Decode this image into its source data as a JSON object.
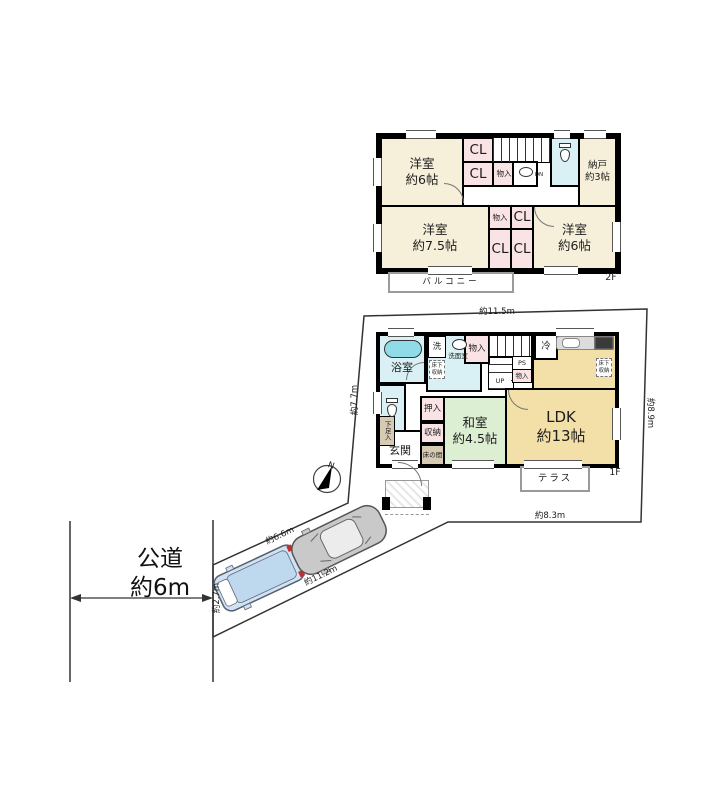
{
  "meta": {
    "title": "間取り図 (floor plan)"
  },
  "colors": {
    "room_cream": "#f6efda",
    "closet_pink": "#f9e3e5",
    "wet_blue": "#d9f1f4",
    "tatami_green": "#ddefd2",
    "ldk_tan": "#f3dfa8",
    "tokonoma_tan": "#d6cbb2",
    "tub_cyan": "#8fdbe8",
    "car_blue": "#cfe3f4",
    "car_gray": "#c9c9c9",
    "wall": "#000000"
  },
  "floor2": {
    "label": "2F",
    "room_nw": "洋室\n約6帖",
    "cl": "CL",
    "monoire": "物入",
    "dn": "DN",
    "nando": "納戸\n約3帖",
    "room_sw": "洋室\n約7.5帖",
    "room_se": "洋室\n約6帖",
    "balcony": "バルコニー"
  },
  "floor1": {
    "label": "1F",
    "bath": "浴室",
    "laundry": "洗",
    "senmen": "洗面室",
    "underfloor": "床下\n収納",
    "monoire": "物入",
    "up": "UP",
    "ps": "PS",
    "fridge": "冷",
    "oshiire": "押入",
    "storage": "収納",
    "tokonoma": "床の間",
    "washitsu": "和室\n約4.5帖",
    "ldk": "LDK\n約13帖",
    "genkan": "玄関",
    "shoe_box": "下足入",
    "terrace": "テラス"
  },
  "site": {
    "road": "公道\n約6m",
    "north": "N",
    "dim_top": "約11.5m",
    "dim_left": "約7.7m",
    "dim_right": "約8.9m",
    "dim_bottom": "約8.3m",
    "dim_drive_upper": "約6.6m",
    "dim_drive_lower": "約11.2m",
    "dim_frontage": "約2.7m"
  }
}
